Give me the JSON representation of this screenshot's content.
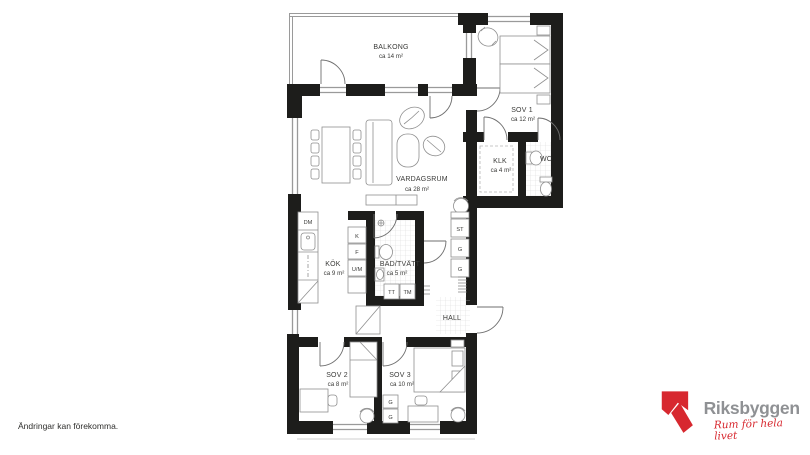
{
  "plan": {
    "rooms": {
      "balkong": {
        "name": "BALKONG",
        "area": "ca 14 m²"
      },
      "sov1": {
        "name": "SOV 1",
        "area": "ca 12 m²"
      },
      "klk": {
        "name": "KLK",
        "area": "ca 4 m²"
      },
      "wc": {
        "name": "WC"
      },
      "vardagsrum": {
        "name": "VARDAGSRUM",
        "area": "ca 28 m²"
      },
      "kok": {
        "name": "KÖK",
        "area": "ca 9 m²"
      },
      "bad": {
        "name": "BAD/TVÄTT",
        "area": "ca 5 m²"
      },
      "hall": {
        "name": "HALL"
      },
      "sov2": {
        "name": "SOV 2",
        "area": "ca 8 m²"
      },
      "sov3": {
        "name": "SOV 3",
        "area": "ca 10 m²"
      }
    },
    "fixtures": {
      "dm": "DM",
      "k": "K",
      "f": "F",
      "um": "U/M",
      "tt": "TT",
      "tm": "TM",
      "st": "ST",
      "g_hall_1": "G",
      "g_hall_2": "G",
      "g_sov3_1": "G",
      "g_sov3_2": "G"
    }
  },
  "footnote": "Ändringar kan förekomma.",
  "brand": {
    "name": "Riksbyggen",
    "tagline": "Rum för hela livet"
  },
  "colors": {
    "wall": "#1d1d1b",
    "line": "#8f8f8f",
    "brand_red": "#d7282f",
    "brand_gray": "#8f9194"
  }
}
